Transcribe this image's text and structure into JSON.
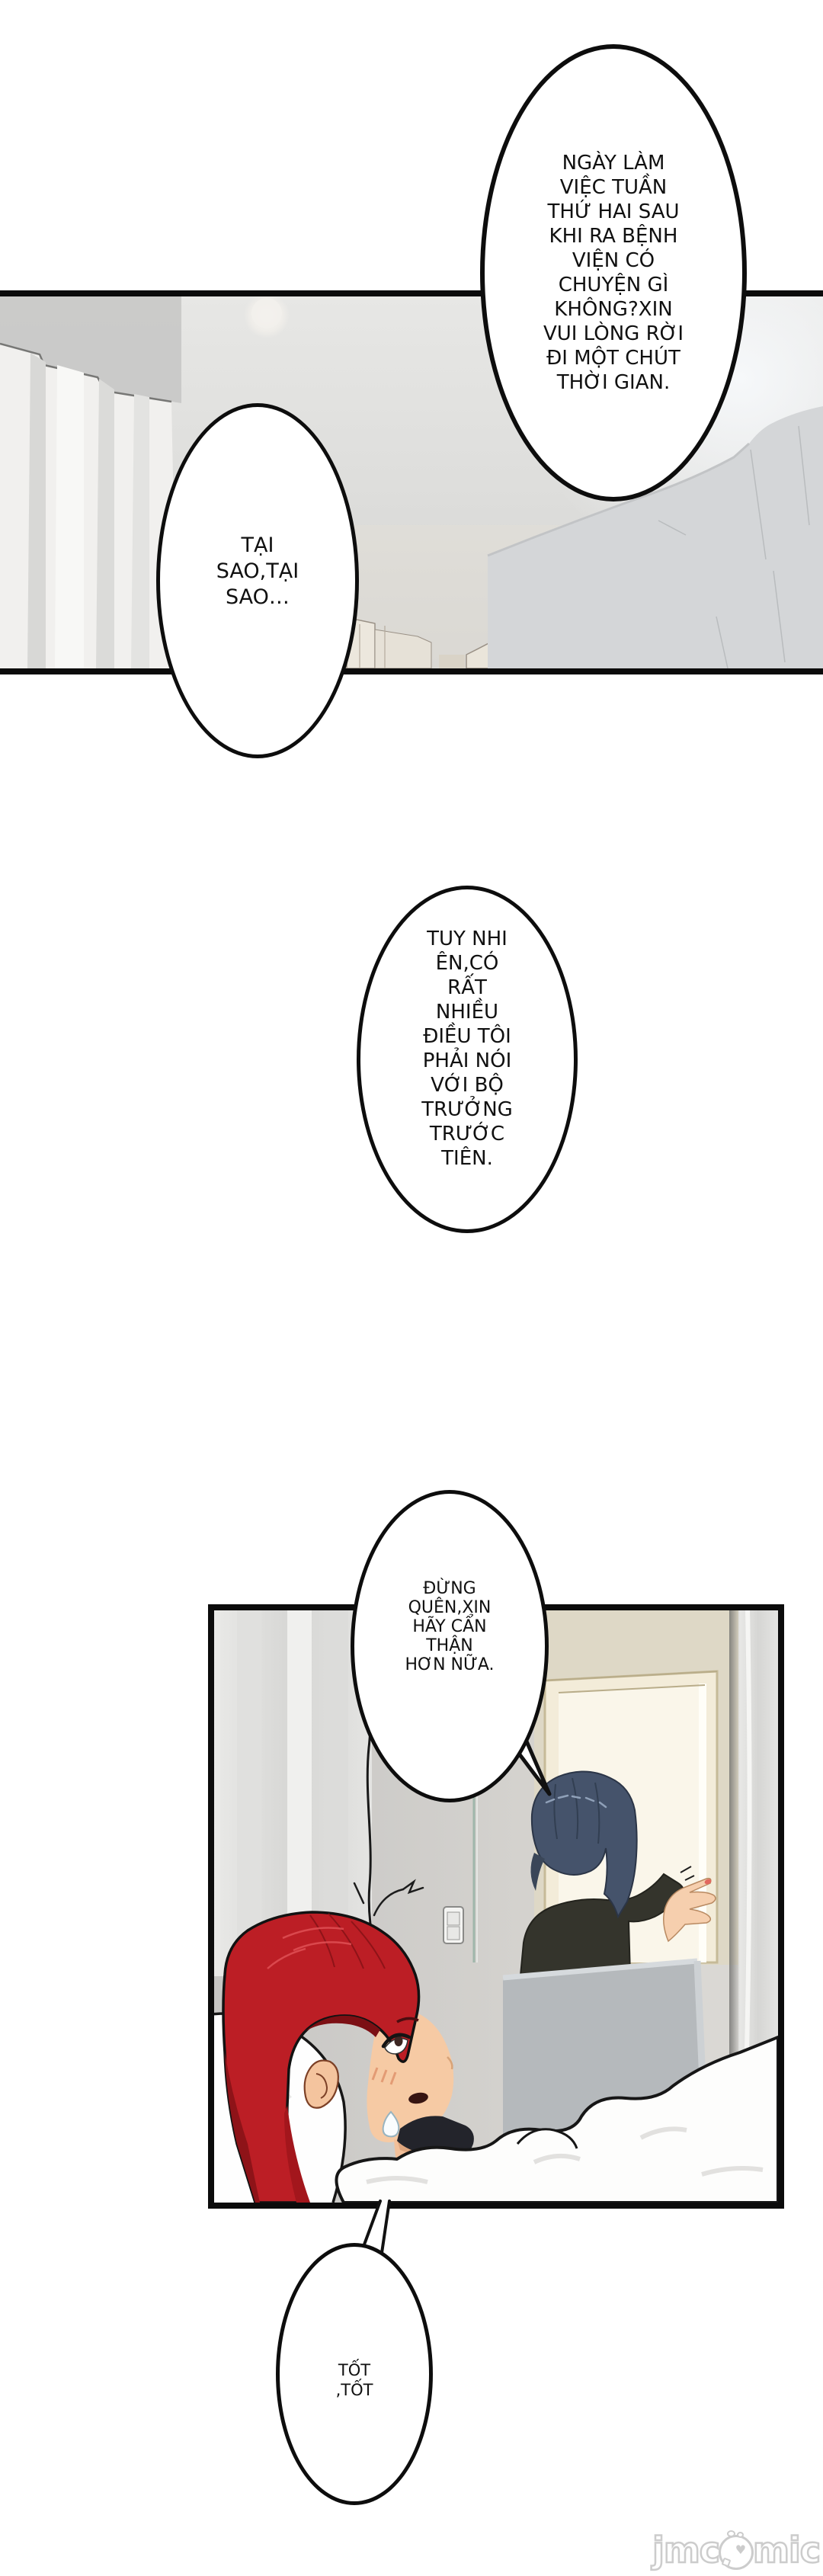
{
  "bubbles": {
    "top": {
      "lines": [
        "NGÀY LÀM",
        "VIỆC TUẦN",
        "THỨ HAI SAU",
        "KHI RA BỆNH",
        "VIỆN CÓ",
        "CHUYỆN GÌ",
        "KHÔNG?XIN",
        "VUI LÒNG RỜI",
        "ĐI MỘT CHÚT",
        "THỜI GIAN."
      ]
    },
    "taisao": {
      "lines": [
        "TẠI",
        "SAO,TẠI",
        "SAO…"
      ]
    },
    "tuynhien": {
      "lines": [
        "TUY NHI",
        "ÊN,CÓ",
        "RẤT",
        "NHIỀU",
        "ĐIỀU TÔI",
        "PHẢI NÓI",
        "VỚI BỘ",
        "TRƯỞNG",
        "TRƯỚC",
        "TIÊN."
      ]
    },
    "dungquen": {
      "lines": [
        "ĐỪNG",
        "QUÊN,XIN",
        "HÃY CẨN",
        "THẬN",
        "HƠN NỮA."
      ]
    },
    "tot": {
      "lines": [
        "TỐT",
        ",TỐT"
      ]
    }
  },
  "watermark": {
    "prefix": "jmc",
    "suffix": "mic",
    "mascot": "chick-face-as-letter-o",
    "heart": "♥"
  },
  "palette": {
    "page_bg": "#ffffff",
    "ink": "#0d0d0d",
    "panel_border": "#0b0b0b",
    "photo_gray": "#d8d7d5",
    "girl_hair_red": "#bc1e25",
    "girl_hair_shadow": "#8c1318",
    "skin": "#f5c9a4",
    "woman_hair_blue": "#45536b",
    "jacket_dark": "#34342c",
    "privacy_screen_gray": "#b5b9bc",
    "doorway_light": "#faf6ea",
    "glass_edge_teal": "#9fb6aa",
    "watermark_gray": "#cccccc"
  }
}
